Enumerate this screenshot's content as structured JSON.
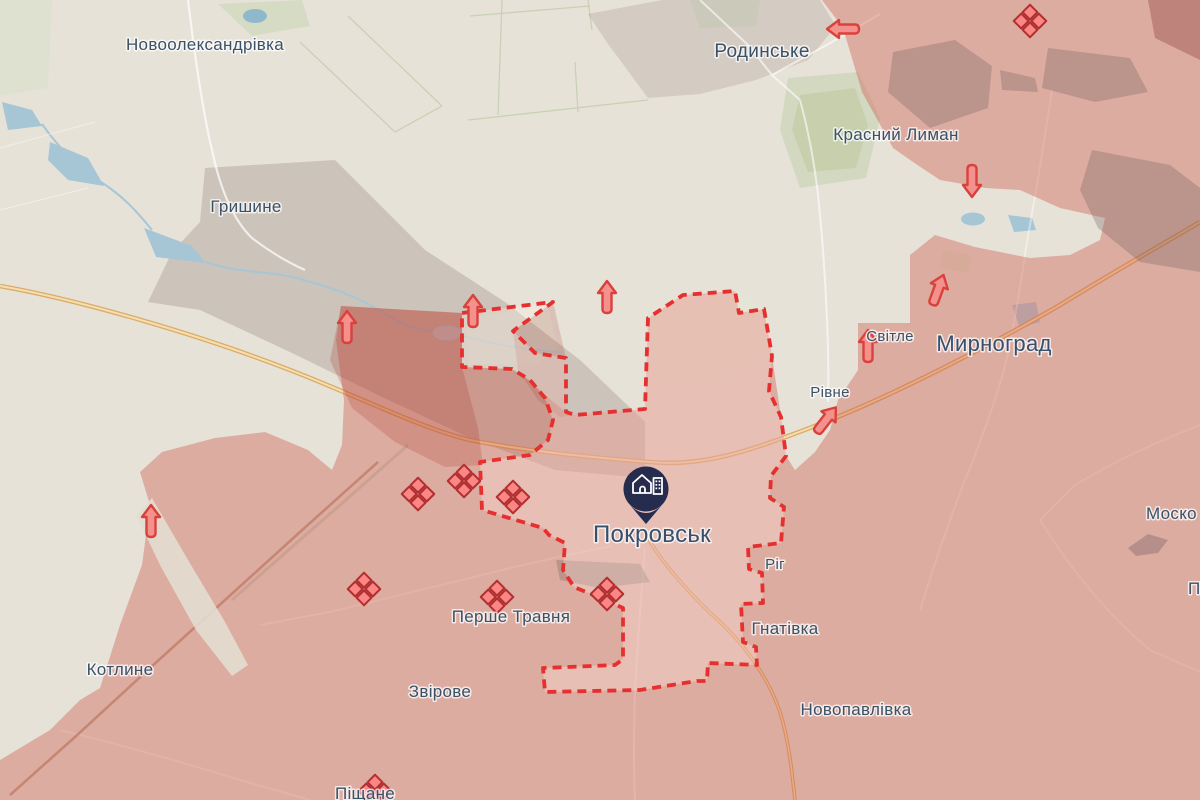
{
  "map": {
    "labels": [
      {
        "id": "novooleksandrivka",
        "text": "Новоолександрівка"
      },
      {
        "id": "hryshyne",
        "text": "Гришине"
      },
      {
        "id": "rodynske",
        "text": "Родинське"
      },
      {
        "id": "krasnyi-lyman",
        "text": "Красний Лиман"
      },
      {
        "id": "svitle",
        "text": "Світле"
      },
      {
        "id": "myrnohrad",
        "text": "Мирноград"
      },
      {
        "id": "rivne",
        "text": "Рівне"
      },
      {
        "id": "pokrovsk",
        "text": "Покровськ"
      },
      {
        "id": "rih",
        "text": "Ріг"
      },
      {
        "id": "hnativka",
        "text": "Гнатівка"
      },
      {
        "id": "pershe-travnia",
        "text": "Перше Травня"
      },
      {
        "id": "zvirove",
        "text": "Звірове"
      },
      {
        "id": "kotlyne",
        "text": "Котлине"
      },
      {
        "id": "novopavlivka",
        "text": "Новопавлівка"
      },
      {
        "id": "pishchane",
        "text": "Піщане"
      },
      {
        "id": "moskovske-partial",
        "text": "Моско"
      },
      {
        "id": "p-partial",
        "text": "П"
      }
    ],
    "marker": {
      "city": "Покровськ",
      "icon": "city-buildings-pin"
    },
    "icons": {
      "assault_diamond_count": 8,
      "attack_arrow_count": 9,
      "assault_icon_name": "assault-diamond-icon",
      "arrow_icon_name": "attack-direction-arrow-icon"
    },
    "colors": {
      "free_territory": "#e7e2d8",
      "occupied_fill": "#cd5548",
      "contested_outline": "#e62f2f",
      "assault_icon_fill": "#fc8585",
      "assault_icon_border": "#b03030",
      "arrow_fill": "#f5918c",
      "arrow_border": "#d9413c",
      "water": "#aac9d9",
      "highway": "#e9c583",
      "label_text": "#3b5166",
      "pin": "#262c4e"
    }
  }
}
